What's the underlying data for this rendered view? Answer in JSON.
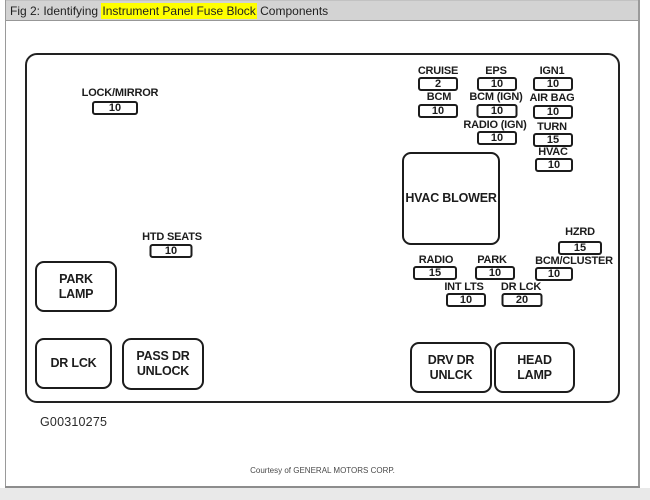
{
  "title_bar": {
    "prefix": "Fig 2: Identifying ",
    "highlighted": "Instrument Panel Fuse Block",
    "suffix": " Components"
  },
  "page": {
    "figure_id": "G00310275",
    "courtesy": "Courtesy of GENERAL MOTORS CORP."
  },
  "colors": {
    "titlebar_bg": "#d3d3d3",
    "highlight": "#ffff00",
    "diagram_line": "#1c1c1c",
    "page_border": "#9a9a9a"
  },
  "fuses": [
    {
      "name": "lock-mirror",
      "label": "LOCK/MIRROR",
      "amp": "10"
    },
    {
      "name": "cruise",
      "label": "CRUISE",
      "amp": "2"
    },
    {
      "name": "eps",
      "label": "EPS",
      "amp": "10"
    },
    {
      "name": "ign1",
      "label": "IGN1",
      "amp": "10"
    },
    {
      "name": "bcm",
      "label": "BCM",
      "amp": "10"
    },
    {
      "name": "bcm-ign",
      "label": "BCM (IGN)",
      "amp": "10"
    },
    {
      "name": "air-bag",
      "label": "AIR BAG",
      "amp": "10"
    },
    {
      "name": "radio-ign",
      "label": "RADIO (IGN)",
      "amp": "10"
    },
    {
      "name": "turn",
      "label": "TURN",
      "amp": "15"
    },
    {
      "name": "hvac",
      "label": "HVAC",
      "amp": "10"
    },
    {
      "name": "htd-seats",
      "label": "HTD SEATS",
      "amp": "10"
    },
    {
      "name": "hzrd",
      "label": "HZRD",
      "amp": "15"
    },
    {
      "name": "radio",
      "label": "RADIO",
      "amp": "15"
    },
    {
      "name": "park",
      "label": "PARK",
      "amp": "10"
    },
    {
      "name": "bcm-cluster",
      "label": "BCM/CLUSTER",
      "amp": "10"
    },
    {
      "name": "int-lts",
      "label": "INT LTS",
      "amp": "10"
    },
    {
      "name": "dr-lck-fuse",
      "label": "DR LCK",
      "amp": "20"
    }
  ],
  "components": [
    {
      "name": "hvac-blower",
      "label": "HVAC BLOWER"
    },
    {
      "name": "park-lamp",
      "label": "PARK\nLAMP"
    },
    {
      "name": "dr-lck",
      "label": "DR LCK"
    },
    {
      "name": "pass-dr-unlock",
      "label": "PASS DR\nUNLOCK"
    },
    {
      "name": "drv-dr-unlck",
      "label": "DRV DR\nUNLCK"
    },
    {
      "name": "head-lamp",
      "label": "HEAD\nLAMP"
    }
  ]
}
